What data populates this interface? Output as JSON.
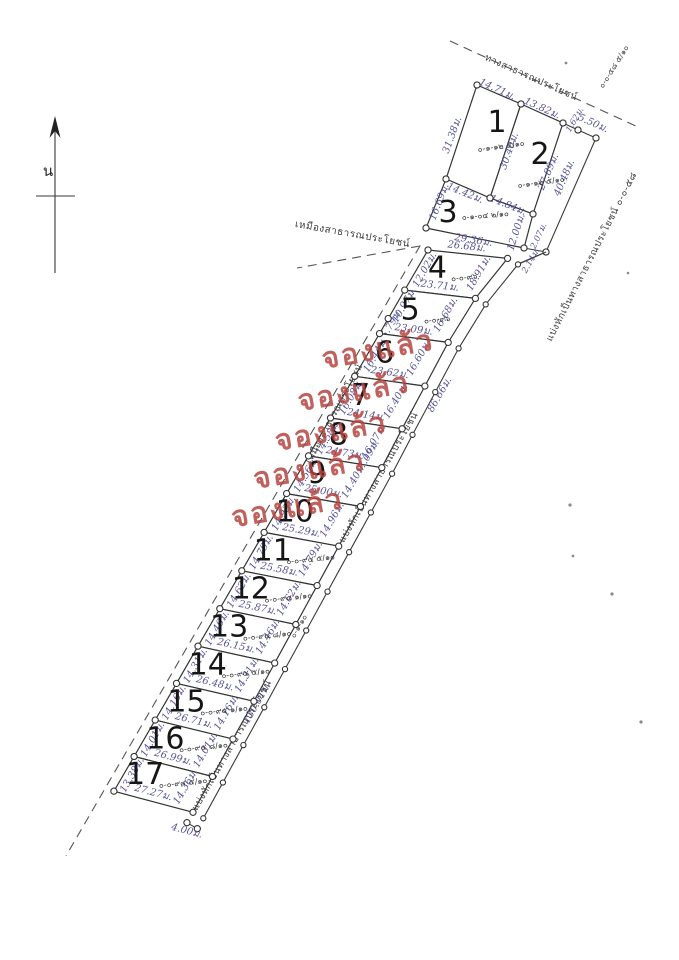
{
  "compass": {
    "label": "น"
  },
  "stamp": {
    "text": "จองแล้ว",
    "plot_numbers": [
      6,
      7,
      8,
      9,
      10
    ],
    "color": "#b5443f"
  },
  "colors": {
    "dimension_text": "#54549a",
    "ink": "#343434",
    "stamp_red": "#b5443f"
  },
  "roads": {
    "top": {
      "label": "ทางสาธารณประโยชน์"
    },
    "right_upper": {
      "label": "แบ่งหักเป็นทางสาธารณประโยชน์ ๐-๐-๕๘",
      "area_note": "๐-๐-๕๘ ๕/๑๐"
    },
    "right_mid": {
      "label": "แบ่งหักเป็นทางสาธารณประโยชน์",
      "length": "86.66ม."
    },
    "right_lower": {
      "label": "แบ่งหักเป็นทางสาธารณประโยชน์",
      "length": "130.01ม.",
      "area_note": "๐-๑-๑๐",
      "end_width": "4.00ม."
    },
    "left_canal_upper": {
      "label": "เหมืองสาธารณประโยชน์"
    },
    "left_canal_mid": {
      "label": "เหมืองสาธารณประโยชน์"
    }
  },
  "plots": [
    {
      "number": "1",
      "area": "๐-๑-๑๒ ๕/๑๐",
      "dims": {
        "top": "14.71ม.",
        "left": "31.38ม.",
        "bottom": "14.42ม.",
        "divider": "30.40ม."
      }
    },
    {
      "number": "2",
      "area": "๐-๑-๑๒ ๕/๑๐",
      "dims": {
        "top": "13.82ม.",
        "jog": "1.62ม.",
        "corner": "5.50ม.",
        "right": "27.89ม.",
        "outer": "40.48ม.",
        "bottom": "14.84ม."
      }
    },
    {
      "number": "3",
      "area": "๐-๑-๐๔ ๒/๑๐",
      "dims": {
        "left": "16.69ม.",
        "bottom": "29.36ม.",
        "right": "12.00ม.",
        "jog": "2.07ม."
      }
    },
    {
      "number": "4",
      "area": "๐-๐-๙๖",
      "dims": {
        "top": "26.68ม.",
        "left": "12.02ม.",
        "right": "18.91ม.",
        "jog": "2.14ม.",
        "bottom": "23.71ม."
      }
    },
    {
      "number": "5",
      "area": "๐-๐-๙๖",
      "dims": {
        "left": "10.97ม.",
        "left2": "5.79ม.",
        "right": "16.68ม.",
        "bottom": "23.09ม."
      }
    },
    {
      "number": "6",
      "area": "",
      "dims": {
        "left": "16.44ม.",
        "right": "16.60ม.",
        "bottom": "23.62ม."
      }
    },
    {
      "number": "7",
      "area": "",
      "dims": {
        "left": "16.08ม.",
        "right": "16.40ม.",
        "bottom": "24.14ม."
      }
    },
    {
      "number": "8",
      "area": "",
      "dims": {
        "left": "14.58ม.",
        "right": "16.07ม.",
        "right2": "17.09ม.",
        "bottom": "24.73ม."
      }
    },
    {
      "number": "9",
      "area": "",
      "dims": {
        "left": "14.56ม.",
        "right": "14.40ม.",
        "bottom": "25.00ม."
      }
    },
    {
      "number": "10",
      "area": "",
      "dims": {
        "left": "14.93ม.",
        "right": "14.96ม.",
        "bottom": "25.29ม."
      }
    },
    {
      "number": "11",
      "area": "๐-๐-๙๔ ๕/๑๐",
      "dims": {
        "left": "14.79ม.",
        "right": "14.79ม.",
        "bottom": "25.58ม."
      }
    },
    {
      "number": "12",
      "area": "๐-๐-๙๔ ๑/๑๐",
      "dims": {
        "left": "14.62ม.",
        "right": "14.62ม.",
        "bottom": "25.87ม."
      }
    },
    {
      "number": "13",
      "area": "๐-๐-๙๔ ๘/๑๐",
      "dims": {
        "left": "14.46ม.",
        "right": "14.46ม.",
        "bottom": "26.15ม."
      }
    },
    {
      "number": "14",
      "area": "๐-๐-๙๔ ๕/๑๐",
      "dims": {
        "left": "14.31ม.",
        "right": "14.31ม.",
        "bottom": "26.48ม."
      }
    },
    {
      "number": "15",
      "area": "๐-๐-๙๕ ๑/๑๐",
      "dims": {
        "left": "14.16ม.",
        "right": "14.16ม.",
        "bottom": "26.71ม."
      }
    },
    {
      "number": "16",
      "area": "๐-๐-๙๕ ๘/๑๐",
      "dims": {
        "left": "14.01ม.",
        "right": "14.01ม.",
        "bottom": "26.99ม."
      }
    },
    {
      "number": "17",
      "area": "๐-๐-๙๔ ๕/๑๐",
      "dims": {
        "left": "13.38ม.",
        "right": "14.36ม.",
        "bottom": "27.27ม.",
        "end": "4.00ม."
      }
    }
  ]
}
